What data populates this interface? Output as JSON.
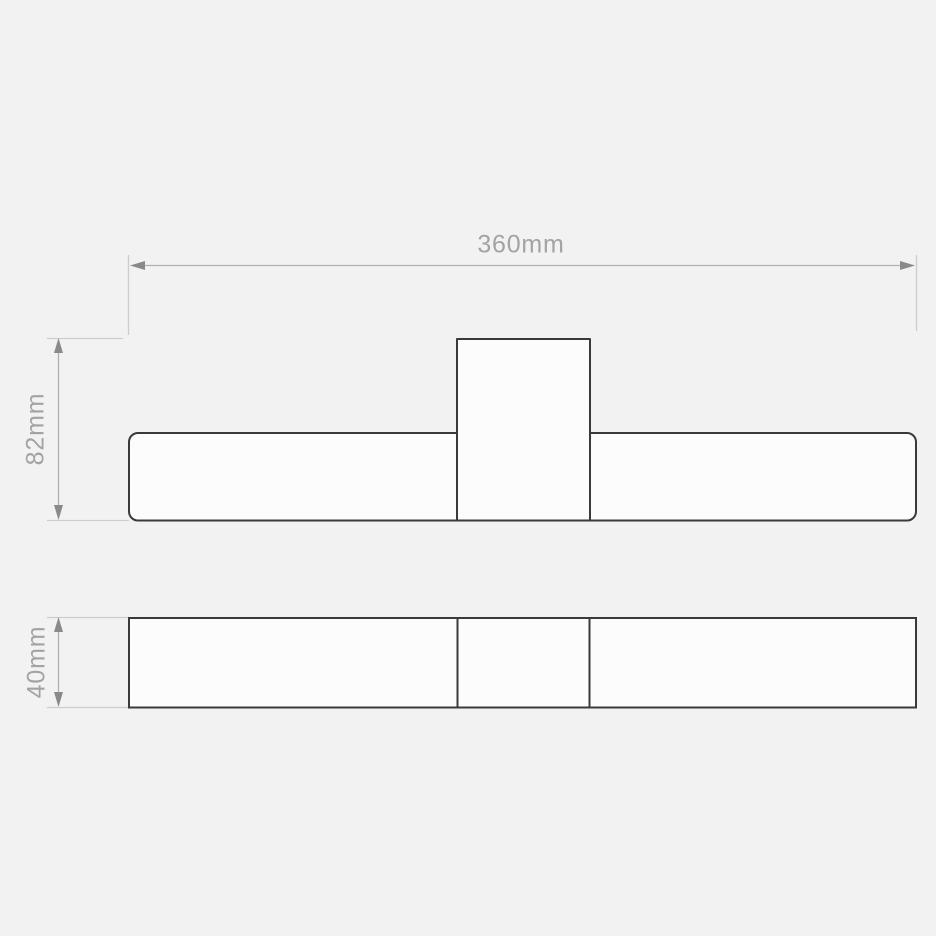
{
  "canvas": {
    "width_px": 936,
    "height_px": 936,
    "background": "#f2f2f2"
  },
  "drawing": {
    "type": "technical-dimension-drawing",
    "views": {
      "front_view": "wide rounded bar with centered rectangular backplate",
      "bottom_view": "long rectangle divided into three sections"
    },
    "annotations": {
      "width_label": "360mm",
      "height_label": "82mm",
      "depth_label": "40mm"
    },
    "colors": {
      "background": "#f2f2f2",
      "outline": "#3a3a3a",
      "shape_fill": "#fcfcfc",
      "dimension_line": "#b0b0b0",
      "extension_line": "#cdcdcd",
      "arrowhead": "#8a8a8a",
      "label_text": "#a3a3a3"
    }
  }
}
